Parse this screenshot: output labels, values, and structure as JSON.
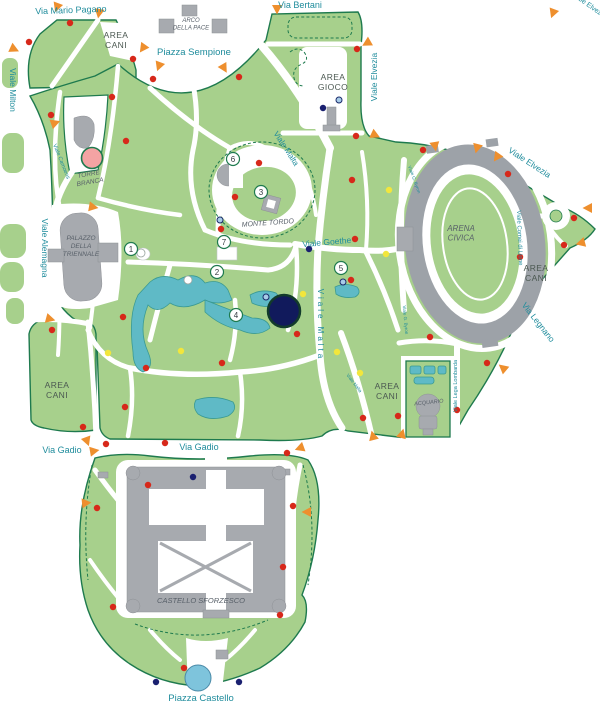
{
  "map": {
    "title_hidden": "",
    "colors": {
      "park_green": "#A7D08C",
      "border_green": "#1E7A4E",
      "street_text": "#1F8C9C",
      "building_text": "#586069",
      "water": "#5FBAC6",
      "red_dot": "#D7281A",
      "yellow_dot": "#F2E63C",
      "navy_dot": "#1A2070",
      "lightblue_dot": "#A8CCE8",
      "orange_triangle": "#EE8F2E",
      "pink_circle": "#F4A3A3",
      "big_navy_circle": "#111A5C",
      "fountain_blue": "#7EC4DC",
      "building_gray": "#A7AAAF"
    },
    "labels": [
      {
        "name": "via-mario-pagano",
        "text": "Via Mario Pagano",
        "x": 71,
        "y": 13,
        "rot": -2,
        "cls": "street",
        "size": 9
      },
      {
        "name": "piazza-sempione",
        "text": "Piazza Sempione",
        "x": 194,
        "y": 55,
        "rot": 0,
        "cls": "street",
        "size": 9.5
      },
      {
        "name": "via-bertani",
        "text": "Via Bertani",
        "x": 300,
        "y": 8,
        "rot": 0,
        "cls": "street",
        "size": 9
      },
      {
        "name": "viale-elvezia-north",
        "text": "Viale Elvezia",
        "x": 377,
        "y": 77,
        "rot": -90,
        "cls": "street",
        "size": 8.5
      },
      {
        "name": "viale-milton",
        "text": "Viale Milton",
        "x": 10,
        "y": 90,
        "rot": 90,
        "cls": "street",
        "size": 8.5
      },
      {
        "name": "viale-malta-northeast",
        "text": "Viale Malta",
        "x": 284,
        "y": 150,
        "rot": 57,
        "cls": "street",
        "size": 8
      },
      {
        "name": "viale-alemagna",
        "text": "Viale Alemagna",
        "x": 42,
        "y": 248,
        "rot": 90,
        "cls": "street",
        "size": 8.5
      },
      {
        "name": "viale-camoens",
        "text": "Viale Camoens",
        "x": 60,
        "y": 162,
        "rot": 68,
        "cls": "street",
        "size": 5.5
      },
      {
        "name": "viale-goethe",
        "text": "Viale Goethe",
        "x": 327,
        "y": 245,
        "rot": -5,
        "cls": "street",
        "size": 8.5
      },
      {
        "name": "viale-elvezia-northeast",
        "text": "Viale Elvezia",
        "x": 528,
        "y": 165,
        "rot": 33,
        "cls": "street",
        "size": 8.5
      },
      {
        "name": "viale-comei-di-lione",
        "text": "Viale Comei di Lione",
        "x": 518,
        "y": 238,
        "rot": 88,
        "cls": "street",
        "size": 6
      },
      {
        "name": "via-legnano",
        "text": "Via Legnano",
        "x": 536,
        "y": 324,
        "rot": 52,
        "cls": "street",
        "size": 8.5
      },
      {
        "name": "viale-malta-south",
        "text": "Viale Malta",
        "x": 318,
        "y": 325,
        "rot": 90,
        "cls": "street",
        "size": 8,
        "ls": 3
      },
      {
        "name": "viale-lega-lombarda",
        "text": "Viale Lega Lombarda",
        "x": 457,
        "y": 386,
        "rot": -90,
        "cls": "street",
        "size": 5.5
      },
      {
        "name": "via-gadio-west",
        "text": "Via Gadio",
        "x": 62,
        "y": 453,
        "rot": 0,
        "cls": "street",
        "size": 9
      },
      {
        "name": "via-gadio-center",
        "text": "Via Gadio",
        "x": 199,
        "y": 450,
        "rot": 0,
        "cls": "street",
        "size": 9
      },
      {
        "name": "piazza-castello",
        "text": "Piazza Castello",
        "x": 201,
        "y": 701,
        "rot": 0,
        "cls": "street",
        "size": 9.5
      },
      {
        "name": "viale-elvezia-corner",
        "text": "Viale Elvezia",
        "x": 588,
        "y": 7,
        "rot": 35,
        "cls": "street",
        "size": 7
      },
      {
        "name": "viale-byron-north",
        "text": "Viale G. Byron",
        "x": 413,
        "y": 180,
        "rot": 70,
        "cls": "street",
        "size": 4.5
      },
      {
        "name": "viale-byron-south",
        "text": "Viale G. Byron",
        "x": 404,
        "y": 320,
        "rot": 85,
        "cls": "street",
        "size": 4.5
      },
      {
        "name": "viale-malta-southeast",
        "text": "Viale Malta",
        "x": 353,
        "y": 384,
        "rot": 52,
        "cls": "street",
        "size": 4.5
      },
      {
        "name": "area-cani-northwest",
        "lines": [
          "AREA",
          "CANI"
        ],
        "x": 116,
        "y": 38,
        "rot": 0,
        "cls": "area",
        "size": 8.5
      },
      {
        "name": "area-gioco",
        "lines": [
          "AREA",
          "GIOCO"
        ],
        "x": 333,
        "y": 80,
        "rot": 0,
        "cls": "area",
        "size": 8.5
      },
      {
        "name": "area-cani-east",
        "lines": [
          "AREA",
          "CANI"
        ],
        "x": 536,
        "y": 271,
        "rot": 0,
        "cls": "area",
        "size": 8.5
      },
      {
        "name": "area-cani-southwest",
        "lines": [
          "AREA",
          "CANI"
        ],
        "x": 57,
        "y": 388,
        "rot": 0,
        "cls": "area",
        "size": 8.5
      },
      {
        "name": "area-cani-south",
        "lines": [
          "AREA",
          "CANI"
        ],
        "x": 387,
        "y": 389,
        "rot": 0,
        "cls": "area",
        "size": 8.5
      },
      {
        "name": "arco-della-pace",
        "lines": [
          "ARCO",
          "DELLA PACE"
        ],
        "x": 191,
        "y": 22,
        "rot": 0,
        "cls": "bldg",
        "size": 6
      },
      {
        "name": "torre-branca",
        "lines": [
          "TORRE",
          "BRANCA"
        ],
        "x": 89,
        "y": 176,
        "rot": -10,
        "cls": "bldg",
        "size": 6.5
      },
      {
        "name": "palazzo-della-triennale",
        "lines": [
          "PALAZZO",
          "DELLA",
          "TRIENNALE"
        ],
        "x": 81,
        "y": 240,
        "rot": 0,
        "cls": "bldg",
        "size": 6.5
      },
      {
        "name": "monte-tordo",
        "text": "MONTE TORDO",
        "x": 268,
        "y": 225,
        "rot": -4,
        "cls": "bldg",
        "size": 7
      },
      {
        "name": "arena-civica",
        "lines": [
          "ARENA",
          "CIVICA"
        ],
        "x": 461,
        "y": 231,
        "rot": 0,
        "cls": "bldg",
        "size": 8
      },
      {
        "name": "acquario",
        "text": "ACQUARIO",
        "x": 429,
        "y": 404,
        "rot": -6,
        "cls": "bldg",
        "size": 5.5
      },
      {
        "name": "castello-sforzesco",
        "text": "CASTELLO SFORZESCO",
        "x": 201,
        "y": 603,
        "rot": 0,
        "cls": "bldg",
        "size": 7.5
      }
    ],
    "numbered_markers": [
      {
        "n": "1",
        "x": 131,
        "y": 249
      },
      {
        "n": "2",
        "x": 217,
        "y": 272
      },
      {
        "n": "3",
        "x": 261,
        "y": 192
      },
      {
        "n": "4",
        "x": 236,
        "y": 315
      },
      {
        "n": "5",
        "x": 341,
        "y": 268
      },
      {
        "n": "6",
        "x": 233,
        "y": 159
      },
      {
        "n": "7",
        "x": 224,
        "y": 242
      }
    ],
    "dots": {
      "red": [
        [
          70,
          23
        ],
        [
          29,
          42
        ],
        [
          133,
          59
        ],
        [
          153,
          79
        ],
        [
          51,
          115
        ],
        [
          112,
          97
        ],
        [
          126,
          141
        ],
        [
          239,
          77
        ],
        [
          357,
          49
        ],
        [
          356,
          136
        ],
        [
          259,
          163
        ],
        [
          235,
          197
        ],
        [
          221,
          229
        ],
        [
          352,
          180
        ],
        [
          355,
          239
        ],
        [
          297,
          334
        ],
        [
          222,
          363
        ],
        [
          146,
          368
        ],
        [
          351,
          280
        ],
        [
          423,
          150
        ],
        [
          508,
          174
        ],
        [
          574,
          218
        ],
        [
          564,
          245
        ],
        [
          520,
          257
        ],
        [
          430,
          337
        ],
        [
          363,
          418
        ],
        [
          398,
          416
        ],
        [
          457,
          410
        ],
        [
          487,
          363
        ],
        [
          106,
          444
        ],
        [
          165,
          443
        ],
        [
          287,
          453
        ],
        [
          148,
          485
        ],
        [
          97,
          508
        ],
        [
          293,
          506
        ],
        [
          283,
          567
        ],
        [
          113,
          607
        ],
        [
          280,
          615
        ],
        [
          184,
          668
        ],
        [
          52,
          330
        ],
        [
          123,
          317
        ],
        [
          125,
          407
        ],
        [
          83,
          427
        ]
      ],
      "yellow": [
        [
          303,
          294
        ],
        [
          389,
          190
        ],
        [
          386,
          254
        ],
        [
          337,
          352
        ],
        [
          360,
          373
        ],
        [
          108,
          353
        ],
        [
          181,
          351
        ]
      ],
      "navy": [
        [
          323,
          108
        ],
        [
          309,
          249
        ],
        [
          193,
          477
        ],
        [
          156,
          682
        ],
        [
          239,
          682
        ]
      ],
      "lightblue": [
        [
          339,
          100
        ],
        [
          220,
          220
        ],
        [
          266,
          297
        ],
        [
          343,
          282
        ]
      ],
      "white": [
        [
          188,
          280
        ],
        [
          141,
          253
        ]
      ]
    },
    "entrance_triangles": [
      [
        57,
        7,
        200
      ],
      [
        99,
        13,
        190
      ],
      [
        14,
        49,
        115
      ],
      [
        143,
        48,
        215
      ],
      [
        159,
        66,
        200
      ],
      [
        224,
        68,
        150
      ],
      [
        277,
        9,
        180
      ],
      [
        367,
        43,
        240
      ],
      [
        375,
        135,
        115
      ],
      [
        553,
        13,
        200
      ],
      [
        435,
        146,
        170
      ],
      [
        477,
        148,
        195
      ],
      [
        497,
        157,
        215
      ],
      [
        588,
        208,
        270
      ],
      [
        581,
        243,
        255
      ],
      [
        503,
        368,
        310
      ],
      [
        402,
        434,
        15
      ],
      [
        373,
        436,
        345
      ],
      [
        93,
        207,
        100
      ],
      [
        55,
        123,
        70
      ],
      [
        50,
        319,
        105
      ],
      [
        87,
        441,
        160
      ],
      [
        94,
        451,
        80
      ],
      [
        300,
        448,
        250
      ],
      [
        86,
        503,
        85
      ],
      [
        307,
        512,
        270
      ]
    ],
    "special_circles": [
      {
        "name": "torre-branca-tower",
        "x": 92,
        "y": 158,
        "r": 10.5,
        "fill": "#F4A3A3",
        "stroke": "#1E7A4E",
        "sw": 1.6
      },
      {
        "name": "big-navy-pond",
        "x": 284,
        "y": 311,
        "r": 16,
        "fill": "#111A5C",
        "stroke": "#123B2B",
        "sw": 2.5
      },
      {
        "name": "piazza-castello-fountain",
        "x": 198,
        "y": 678,
        "r": 13,
        "fill": "#7EC4DC",
        "stroke": "#4A8AA8",
        "sw": 1
      }
    ]
  }
}
